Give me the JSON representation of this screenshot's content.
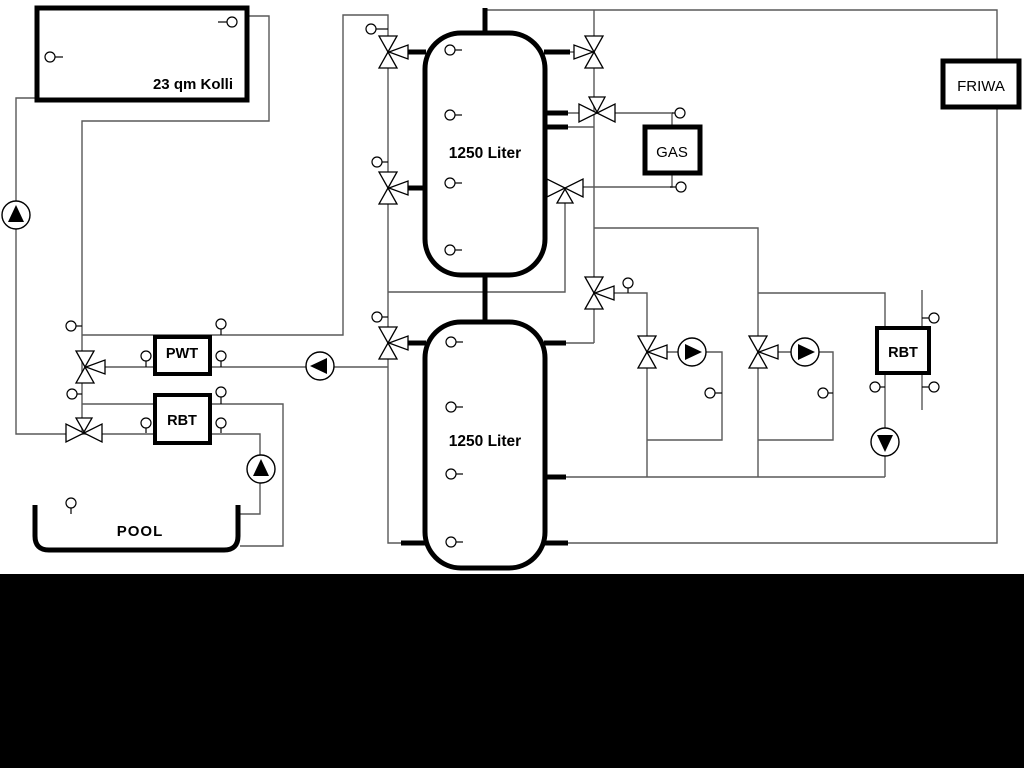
{
  "schematic": {
    "labels": {
      "collector": "23 qm Kolli",
      "tank_top": "1250 Liter",
      "tank_bottom": "1250 Liter",
      "gas_boiler": "GAS",
      "friwa": "FRIWA",
      "pwt": "PWT",
      "rbt_left": "RBT",
      "rbt_right": "RBT",
      "pool": "POOL"
    },
    "colors": {
      "pipe": "#595959",
      "component_stroke": "#000000",
      "background": "#ffffff",
      "footer_band": "#000000"
    }
  }
}
